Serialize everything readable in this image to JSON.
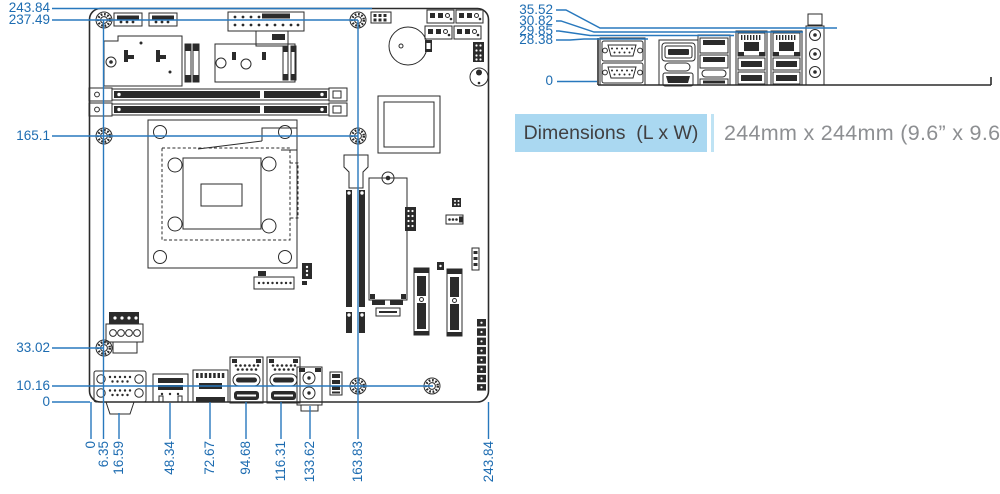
{
  "board_view": {
    "left_dim_labels": [
      "243.84",
      "237.49",
      "165.1",
      "33.02",
      "10.16",
      "0"
    ],
    "bottom_dim_labels": [
      "0",
      "6.35",
      "16.59",
      "48.34",
      "72.67",
      "94.68",
      "116.31",
      "133.62",
      "163.83",
      "243.84"
    ]
  },
  "rear_io_view": {
    "dim_labels": [
      "35.52",
      "30.82",
      "29.85",
      "28.38",
      "0"
    ]
  },
  "dimensions_row": {
    "label": "Dimensions  (L x W)",
    "value": "244mm x 244mm (9.6” x 9.6”)"
  },
  "colors": {
    "dimension_line": "#2878bd",
    "dimension_text": "#1d6cb1",
    "artwork_line": "#2b2b2b",
    "label_box_bg": "#aad8f1",
    "label_box_text": "#414042",
    "value_text": "#8d8f92"
  }
}
